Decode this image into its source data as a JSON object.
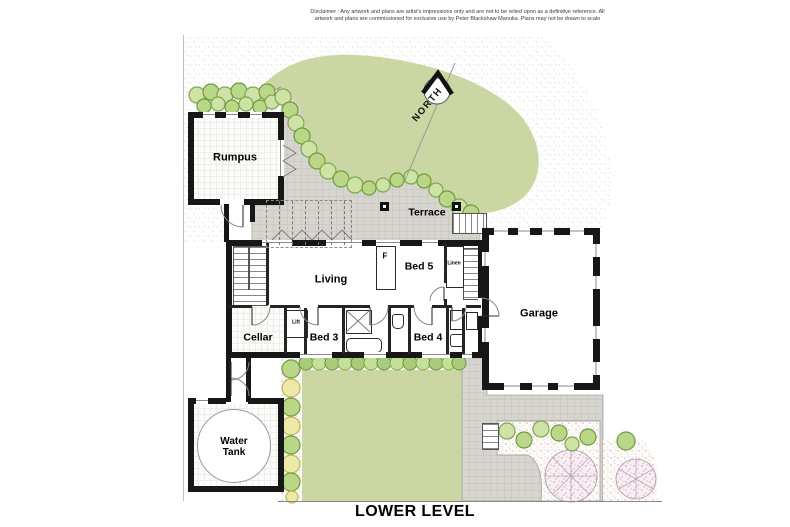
{
  "disclaimer": {
    "line1": "Disclaimer : Any artwork and plans are artist's impressions only and are not to be relied upon as a definitive reference. All",
    "line2": "artwork and plans are commissioned for exclusive use by Peter Blackshaw Manuka. Plans may not be drawn to scale"
  },
  "title": {
    "label": "LOWER LEVEL"
  },
  "compass": {
    "label": "NORTH"
  },
  "rooms": {
    "rumpus": {
      "label": "Rumpus"
    },
    "terrace": {
      "label": "Terrace"
    },
    "living": {
      "label": "Living"
    },
    "bed5": {
      "label": "Bed 5"
    },
    "fireplace": {
      "label": "F"
    },
    "linen": {
      "label": "Linen"
    },
    "cellar": {
      "label": "Cellar"
    },
    "lift": {
      "label": "Lift"
    },
    "bed3": {
      "label": "Bed 3"
    },
    "bed4": {
      "label": "Bed 4"
    },
    "garage": {
      "label": "Garage"
    },
    "water_tank": {
      "label": "Water Tank"
    }
  },
  "colors": {
    "wall": "#171717",
    "lawn": "#cbd7a2",
    "paving": "#d7d5cf",
    "shrub_green": "#b9d787",
    "shrub_yellow": "#ede9a6",
    "bloom_pink": "#e0b4ca"
  }
}
